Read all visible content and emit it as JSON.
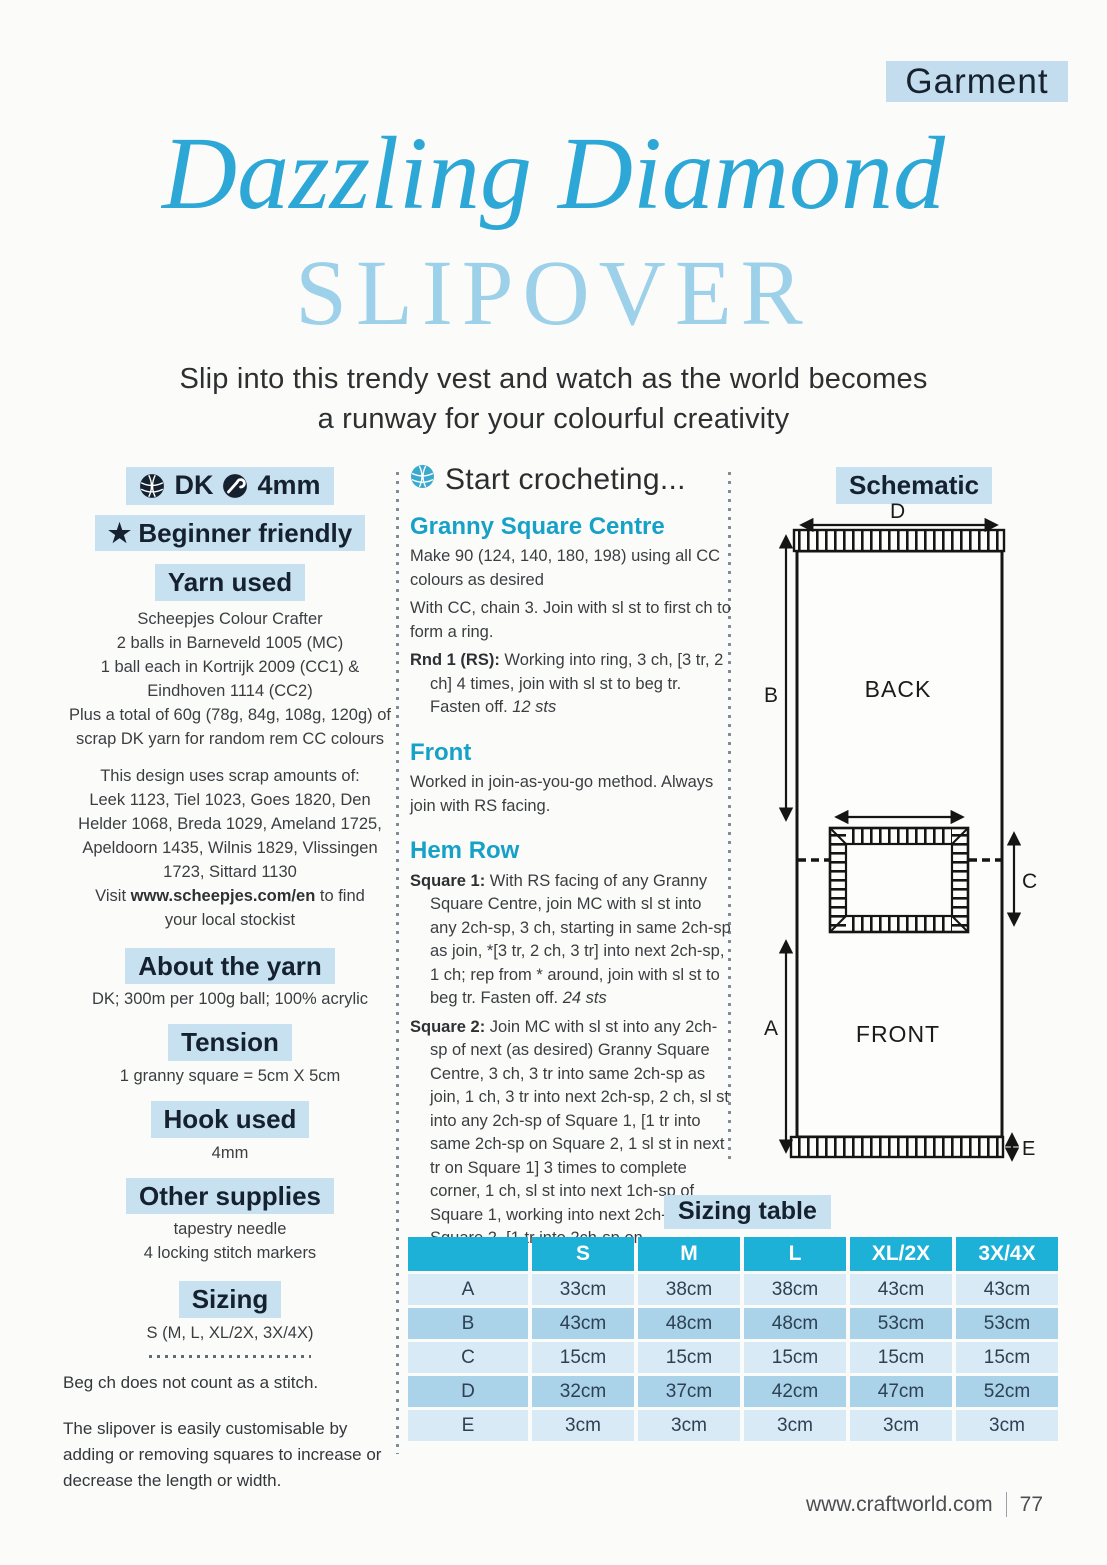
{
  "page": {
    "tag": "Garment",
    "title_line1": "Dazzling Diamond",
    "title_line2": "SLIPOVER",
    "subtitle_line1": "Slip into this trendy vest and watch as the world becomes",
    "subtitle_line2": "a runway for your colourful creativity"
  },
  "colors": {
    "accent_cyan": "#2da7d6",
    "title_light_blue": "#9dd0e9",
    "box_light_blue": "#c7e1f0",
    "subheading_teal": "#16a2c8",
    "table_header": "#1db1d8",
    "table_row_light": "#d8eaf6",
    "table_row_dark": "#aad2e9",
    "dark_navy_text": "#16212f"
  },
  "icons": {
    "yarn_ball": "yarn-ball-icon",
    "crochet_hook": "crochet-hook-icon",
    "star": "★"
  },
  "left": {
    "badge": {
      "dk": "DK",
      "hook": "4mm"
    },
    "beginner": {
      "star": "★",
      "label": "Beginner friendly"
    },
    "yarn_used": {
      "heading": "Yarn used",
      "lines": [
        "Scheepjes Colour Crafter",
        "2 balls in Barneveld 1005 (MC)",
        "1 ball each in Kortrijk 2009 (CC1) &",
        "Eindhoven 1114 (CC2)",
        "Plus a total of 60g (78g, 84g, 108g, 120g) of",
        "scrap DK yarn for random rem CC colours"
      ],
      "scrap_lines": [
        "This design uses scrap amounts of:",
        "Leek 1123, Tiel 1023, Goes 1820, Den",
        "Helder 1068, Breda 1029, Ameland 1725,",
        "Apeldoorn 1435, Wilnis 1829, Vlissingen",
        "1723, Sittard 1130"
      ],
      "visit_prefix": "Visit ",
      "visit_url": "www.scheepjes.com/en",
      "visit_suffix": " to find",
      "visit_line2": "your local stockist"
    },
    "about": {
      "heading": "About the yarn",
      "text": "DK; 300m per 100g ball; 100% acrylic"
    },
    "tension": {
      "heading": "Tension",
      "text": "1 granny square = 5cm X 5cm"
    },
    "hook": {
      "heading": "Hook used",
      "text": "4mm"
    },
    "supplies": {
      "heading": "Other supplies",
      "lines": [
        "tapestry needle",
        "4 locking stitch markers"
      ]
    },
    "sizing": {
      "heading": "Sizing",
      "text": "S (M, L, XL/2X, 3X/4X)"
    },
    "notes": {
      "note1": "Beg ch does not count as a stitch.",
      "note2": "The slipover is easily customisable by adding or removing squares to increase or decrease the length or width."
    }
  },
  "start": {
    "heading": "Start crocheting...",
    "granny": {
      "heading": "Granny Square Centre",
      "p1": "Make 90 (124, 140, 180, 198) using all CC colours as desired",
      "p2": "With CC, chain 3. Join with sl st to first ch to form a ring.",
      "rnd1_label": "Rnd 1 (RS):",
      "rnd1_text": " Working into ring, 3 ch, [3 tr, 2 ch] 4 times, join with sl st to beg tr. Fasten off. ",
      "rnd1_sts": "12 sts"
    },
    "front": {
      "heading": "Front",
      "p1": "Worked in join-as-you-go method. Always join with RS facing."
    },
    "hem": {
      "heading": "Hem Row",
      "sq1_label": "Square 1:",
      "sq1_text": " With RS facing of any Granny Square Centre, join MC with sl st into any 2ch-sp, 3 ch, starting in same 2ch-sp as join, *[3 tr, 2 ch, 3 tr] into next 2ch-sp, 1 ch; rep from * around, join with sl st to beg tr. Fasten off. ",
      "sq1_sts": "24 sts",
      "sq2_label": "Square 2:",
      "sq2_text": " Join MC with sl st into any 2ch-sp of next (as desired) Granny Square Centre, 3 ch, 3 tr into same 2ch-sp as join, 1 ch, 3 tr into next 2ch-sp, 2 ch, sl st into any 2ch-sp of Square 1, [1 tr into same 2ch-sp on Square 2, 1 sl st in next tr on Square 1] 3 times to complete corner, 1 ch, sl st into next 1ch-sp of Square 1, working into next 2ch-sp on Square 2, [1 tr into 2ch-sp on"
    }
  },
  "schematic": {
    "label": "Schematic",
    "back": "BACK",
    "front": "FRONT",
    "dims": {
      "a": "A",
      "b": "B",
      "c": "C",
      "d": "D",
      "e": "E"
    }
  },
  "sizing_table": {
    "title": "Sizing table",
    "columns": [
      "S",
      "M",
      "L",
      "XL/2X",
      "3X/4X"
    ],
    "rows": [
      {
        "label": "A",
        "values": [
          "33cm",
          "38cm",
          "38cm",
          "43cm",
          "43cm"
        ]
      },
      {
        "label": "B",
        "values": [
          "43cm",
          "48cm",
          "48cm",
          "53cm",
          "53cm"
        ]
      },
      {
        "label": "C",
        "values": [
          "15cm",
          "15cm",
          "15cm",
          "15cm",
          "15cm"
        ]
      },
      {
        "label": "D",
        "values": [
          "32cm",
          "37cm",
          "42cm",
          "47cm",
          "52cm"
        ]
      },
      {
        "label": "E",
        "values": [
          "3cm",
          "3cm",
          "3cm",
          "3cm",
          "3cm"
        ]
      }
    ]
  },
  "footer": {
    "url": "www.craftworld.com",
    "page_number": "77"
  }
}
